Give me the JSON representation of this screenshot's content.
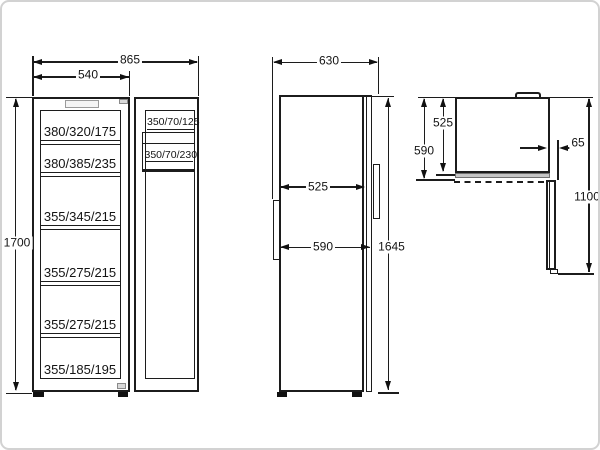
{
  "front_view": {
    "overall_width": "865",
    "cabinet_width": "540",
    "height": "1700",
    "shelves": [
      "380/320/175",
      "380/385/235",
      "355/345/215",
      "355/275/215",
      "355/275/215",
      "355/185/195"
    ],
    "door_bins": [
      "350/70/125",
      "350/70/230"
    ]
  },
  "side_view": {
    "overall_depth": "630",
    "body_depth": "525",
    "door_depth": "590",
    "height": "1645"
  },
  "top_view": {
    "body_depth": "525",
    "total_depth": "590",
    "door_thickness": "65",
    "open_clearance": "1100"
  }
}
